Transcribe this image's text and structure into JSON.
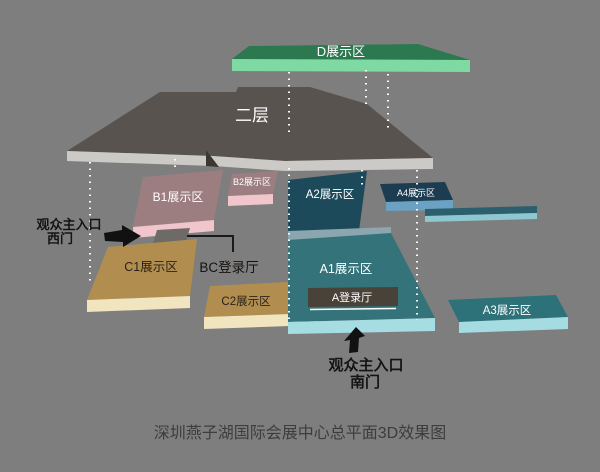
{
  "caption": "深圳燕子湖国际会展中心总平面3D效果图",
  "areas": {
    "d": {
      "label": "D展示区"
    },
    "floor2": {
      "label": "二层"
    },
    "b1": {
      "label": "B1展示区"
    },
    "b2": {
      "label": "B2展示区"
    },
    "a2": {
      "label": "A2展示区"
    },
    "a4": {
      "label": "A4展示区"
    },
    "a1": {
      "label": "A1展示区"
    },
    "a_hall": {
      "label": "A登录厅"
    },
    "a3": {
      "label": "A3展示区"
    },
    "c1": {
      "label": "C1展示区"
    },
    "c2": {
      "label": "C2展示区"
    },
    "bc_hall": {
      "label": "BC登录厅"
    }
  },
  "entrances": {
    "west": {
      "line1": "观众主入口",
      "line2": "西门"
    },
    "south": {
      "line1": "观众主入口",
      "line2": "南门"
    }
  },
  "colors": {
    "bg": "#7e7e7e",
    "d_top": "#2c7950",
    "d_side": "#7ed9a2",
    "f2_top": "#595350",
    "f2_side": "#cbcac6",
    "f2_notch": "#3b3733",
    "b_top": "#9d7e80",
    "b_side": "#f1c5cc",
    "a2_top": "#1d4a5a",
    "a_strip": "#8ba6ae",
    "a1_top": "#347379",
    "a1_side": "#a6dde3",
    "a_hall_bar": "#494238",
    "a4_top": "#1c3c51",
    "a4_side": "#6ba2c4",
    "a3_top": "#2d7179",
    "a3_side": "#a4dce1",
    "c_top": "#b18e50",
    "c_side": "#f1e5c0",
    "corridor_top": "#2b5f6d",
    "corridor_side": "#8fc7d1",
    "connector": "#6e6a66"
  }
}
